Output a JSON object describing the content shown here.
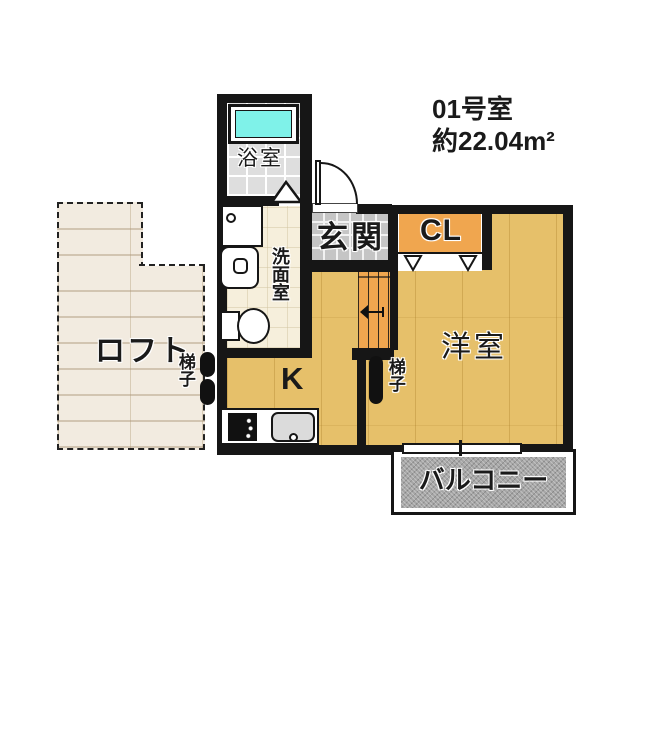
{
  "unit_info": {
    "room_number": "01号室",
    "area": "約22.04m²"
  },
  "rooms": {
    "bathroom": {
      "label": "浴室"
    },
    "washroom": {
      "label": "洗面室"
    },
    "entrance": {
      "label": "玄関"
    },
    "closet": {
      "label": "CL"
    },
    "western_room": {
      "label": "洋室"
    },
    "kitchen": {
      "label": "K"
    },
    "loft": {
      "label": "ロフト"
    },
    "balcony": {
      "label": "バルコニー"
    }
  },
  "fixtures": {
    "ladder_at_loft": {
      "label": "梯子"
    },
    "ladder_in_room": {
      "label": "梯子"
    }
  },
  "colors": {
    "wall": "#161616",
    "wood_floor": "#E6C06A",
    "closet_orange": "#F0A64F",
    "bathtub_cyan": "#7FF2E9",
    "bath_tile": "#DEDEDE",
    "entrance_tile": "#C5C5C5",
    "washroom_floor": "#F6EFDC",
    "loft_floor": "#F2EBE0",
    "balcony_gray": "#A6A6A6"
  }
}
